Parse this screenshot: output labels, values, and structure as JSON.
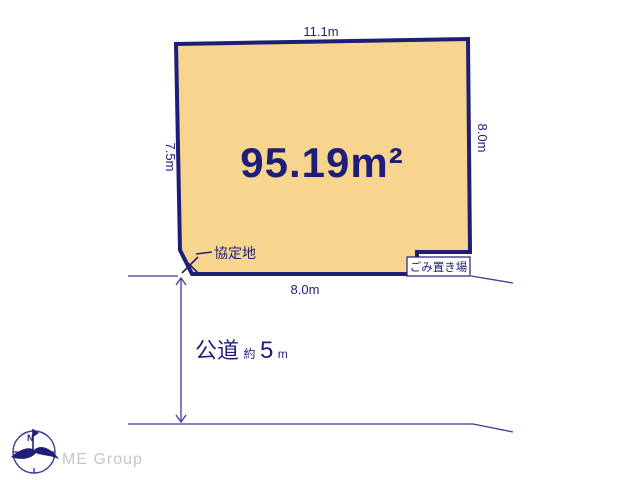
{
  "diagram": {
    "top_width_label": "11.1m",
    "left_width_label": "7.5m",
    "right_width_label": "8.0m",
    "bottom_width_label": "8.0m",
    "area_label": "95.19m²",
    "agreement_area_label": "協定地",
    "garbage_area_label": "ごみ置き場",
    "road_label": {
      "name": "公道",
      "approx_prefix": "約",
      "width_value": "5",
      "unit": "m"
    }
  },
  "branding": {
    "company_name": "ME Group",
    "compass_north_label": "N"
  },
  "colors": {
    "lot_fill": "#F8D58F",
    "navy": "#1E1E78",
    "thin_line": "#3C3C99",
    "logo_gray": "#C6C6C6",
    "background": "#FFFFFF"
  }
}
